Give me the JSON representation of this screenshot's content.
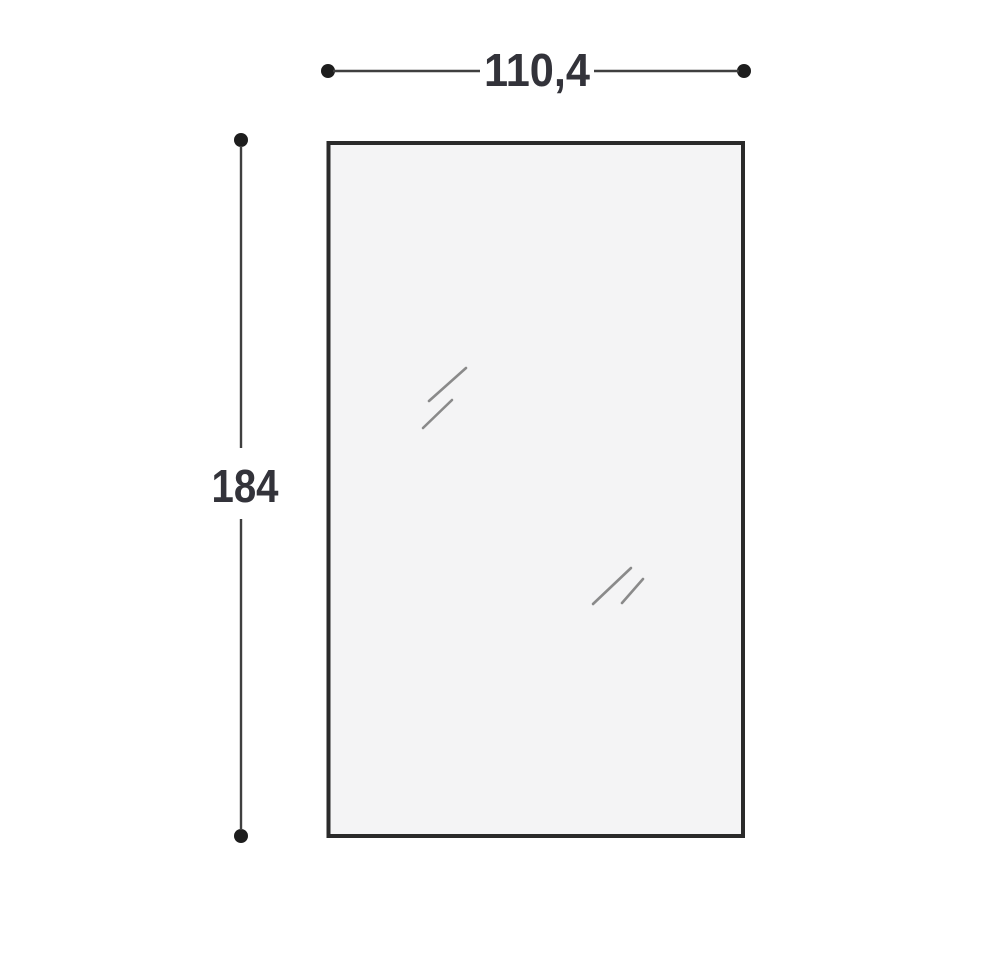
{
  "diagram": {
    "type": "dimension-drawing",
    "subject": "rectangular glass/mirror panel front view",
    "panel": {
      "fill": "#f4f4f5",
      "border_color": "#2a2a2a"
    },
    "dimensions": {
      "width": {
        "label": "110,4"
      },
      "height": {
        "label": "184"
      }
    },
    "colors": {
      "background": "#ffffff",
      "dimension_line": "#3f3f3f",
      "endpoint_dot": "#1d1d1d",
      "label_text": "#33333a",
      "reflection_mark": "#8a8a8a"
    }
  }
}
